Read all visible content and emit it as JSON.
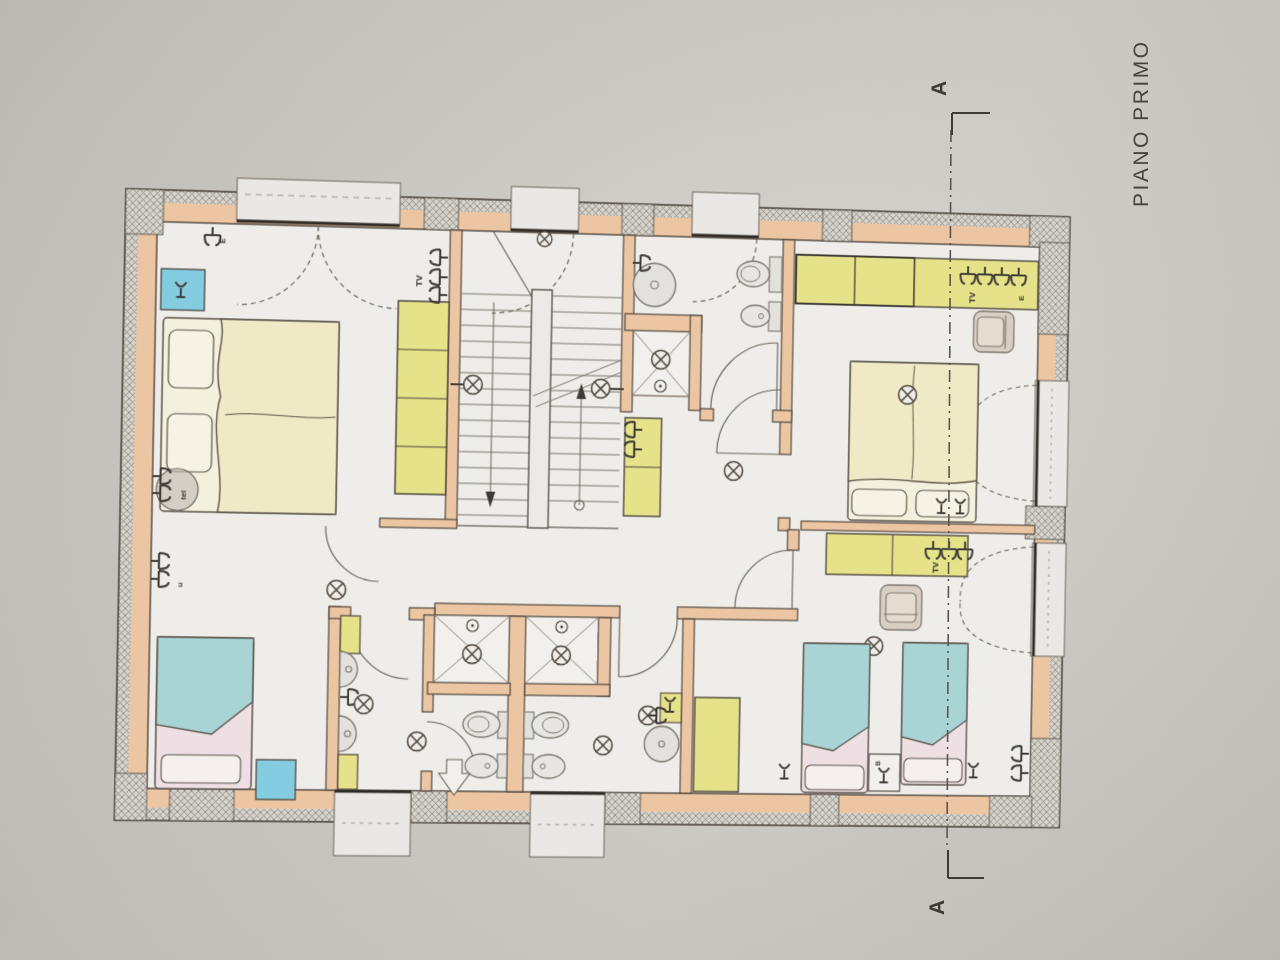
{
  "title": "PIANO PRIMO",
  "section": {
    "marker_top": "A",
    "marker_bottom": "A"
  },
  "labels": {
    "tv": "TV",
    "tel": "tel",
    "u": "u",
    "e": "E",
    "b": "B"
  },
  "colors": {
    "paper": "#cdcac5",
    "floor": "#efede9",
    "wall_fill": "#ecc6a2",
    "wall_line": "#4d443c",
    "hatch": "#8d8980",
    "wardrobe_yellow": "#e5e28a",
    "bed_cream": "#efeac5",
    "bed_teal": "#a9d4d5",
    "sheet_pink": "#eddfe4",
    "nightstand_blue": "#84cde1",
    "armchair_beige": "#d9cec2",
    "fixture_gray": "#e3e1dd",
    "section_line": "#5a564f",
    "text": "#454340"
  }
}
